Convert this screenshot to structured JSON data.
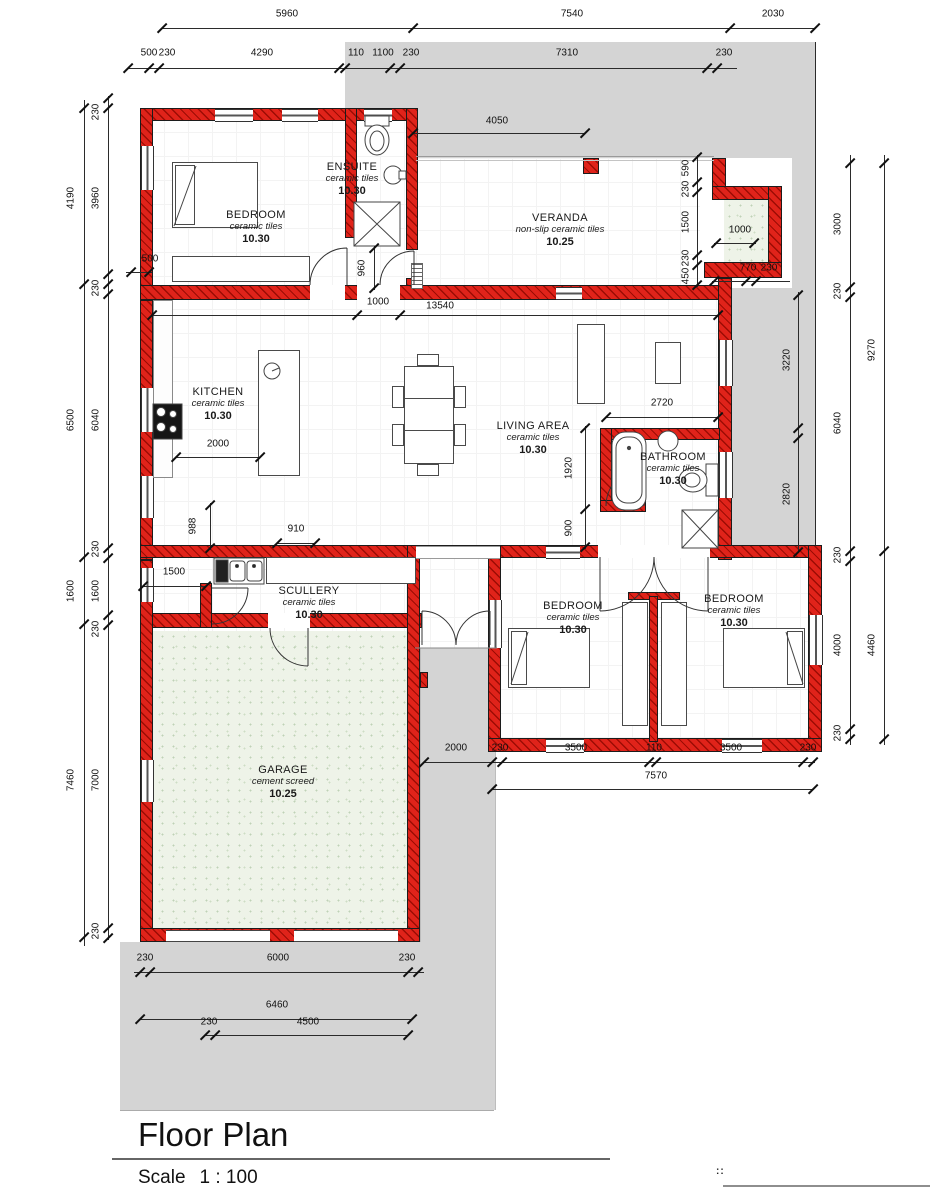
{
  "title_block": {
    "title": "Floor Plan",
    "scale_label": "Scale",
    "scale_value": "1 : 100"
  },
  "footer": {
    "marks": "::"
  },
  "colors": {
    "wall_red": "#e0231a",
    "site_gray": "#d4d4d4",
    "screed_green": "#eef3e8"
  },
  "rooms": [
    {
      "name": "BEDROOM",
      "material": "ceramic tiles",
      "area": "10.30"
    },
    {
      "name": "ENSUITE",
      "material": "ceramic tiles",
      "area": "10.30"
    },
    {
      "name": "VERANDA",
      "material": "non-slip ceramic tiles",
      "area": "10.25"
    },
    {
      "name": "KITCHEN",
      "material": "ceramic tiles",
      "area": "10.30"
    },
    {
      "name": "LIVING AREA",
      "material": "ceramic tiles",
      "area": "10.30"
    },
    {
      "name": "BATHROOM",
      "material": "ceramic tiles",
      "area": "10.30"
    },
    {
      "name": "SCULLERY",
      "material": "ceramic tiles",
      "area": "10.30"
    },
    {
      "name": "BEDROOM",
      "material": "ceramic tiles",
      "area": "10.30"
    },
    {
      "name": "BEDROOM",
      "material": "ceramic tiles",
      "area": "10.30"
    },
    {
      "name": "GARAGE",
      "material": "cement screed",
      "area": "10.25"
    }
  ],
  "dims": {
    "top1": [
      "5960",
      "7540",
      "2030"
    ],
    "top2": [
      "500",
      "230",
      "4290",
      "110",
      "1100",
      "230",
      "7310",
      "230"
    ],
    "left_outer": [
      "4190",
      "6500",
      "1600",
      "7460"
    ],
    "left_inner": [
      "230",
      "3960",
      "230",
      "6040",
      "230",
      "1600",
      "230",
      "7000",
      "230"
    ],
    "left_500": "500",
    "right_inner": [
      "3000",
      "230",
      "6040",
      "230",
      "4000",
      "230"
    ],
    "right_outer": [
      "9270",
      "4460"
    ],
    "right_mid": [
      "3220",
      "2820"
    ],
    "veranda_top": "4050",
    "veranda_right": [
      "590",
      "230",
      "1500",
      "230",
      "450"
    ],
    "braai": [
      "1000",
      "770",
      "230"
    ],
    "kitchen_top": [
      "1000",
      "13540"
    ],
    "kitchen": [
      "2000",
      "988",
      "910"
    ],
    "living": [
      "2720",
      "1920",
      "900"
    ],
    "ensuite": "960",
    "scullery": "1500",
    "bed_row1": [
      "2000",
      "230",
      "3500",
      "110",
      "3500",
      "230"
    ],
    "bed_row2": "7570",
    "garage_row1": [
      "230",
      "6000",
      "230"
    ],
    "garage_row2": "6460",
    "garage_row3": [
      "230",
      "4500"
    ]
  }
}
